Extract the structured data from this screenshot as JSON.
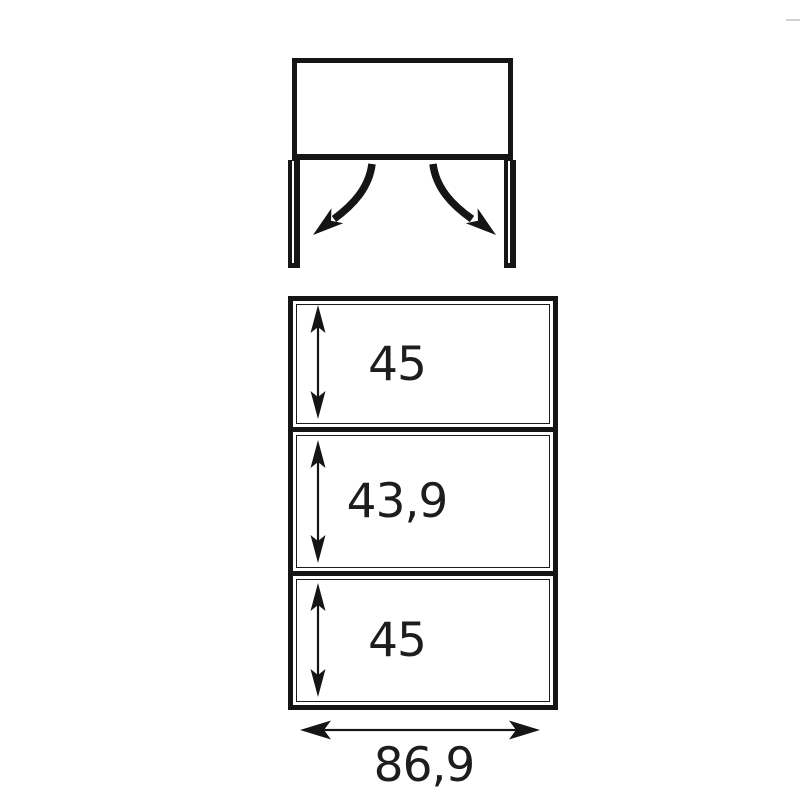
{
  "colors": {
    "line": "#151515",
    "text": "#1d1d1f",
    "background": "#ffffff"
  },
  "top_view": {
    "name": "cabinet-top-view-flap-opening",
    "left_arrow_icon": "curved-arrow-down-left",
    "right_arrow_icon": "curved-arrow-down-right"
  },
  "front_view": {
    "name": "cabinet-front-view-dimensions",
    "compartments": [
      {
        "height_label": "45"
      },
      {
        "height_label": "43,9"
      },
      {
        "height_label": "45"
      }
    ],
    "width_label": "86,9"
  }
}
